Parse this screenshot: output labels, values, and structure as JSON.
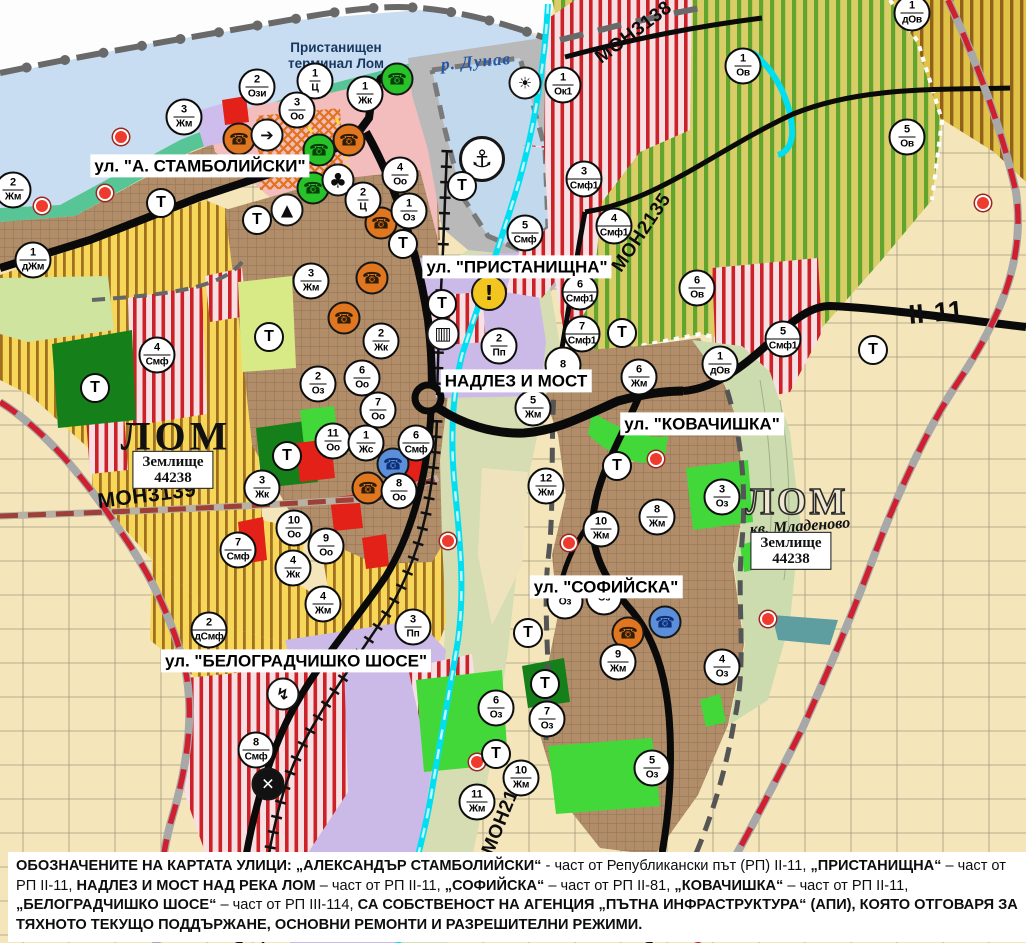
{
  "map": {
    "street_labels": [
      {
        "text": "ул. \"А. СТАМБОЛИЙСКИ\"",
        "x": 200,
        "y": 166
      },
      {
        "text": "ул. \"ПРИСТАНИЩНА\"",
        "x": 517,
        "y": 267
      },
      {
        "text": "НАДЛЕЗ И МОСТ",
        "x": 516,
        "y": 381
      },
      {
        "text": "ул. \"КОВАЧИШКА\"",
        "x": 702,
        "y": 424
      },
      {
        "text": "ул. \"СОФИЙСКА\"",
        "x": 606,
        "y": 587
      },
      {
        "text": "ул. \"БЕЛОГРАДЧИШКО ШОСЕ\"",
        "x": 296,
        "y": 661
      }
    ],
    "area_labels": [
      {
        "text": "р. Дунав",
        "x": 476,
        "y": 62,
        "rot": -5,
        "style": "river"
      },
      {
        "text": "Пристанищен\nтерминал Лом",
        "x": 336,
        "y": 56,
        "rot": 0,
        "style": "terminal"
      },
      {
        "text": "ЛОМ",
        "x": 176,
        "y": 436,
        "rot": 0,
        "style": "lom"
      },
      {
        "text": "ЛОМ",
        "x": 797,
        "y": 502,
        "rot": 0,
        "style": "lom-outline"
      },
      {
        "text": "кв. Младеново",
        "x": 800,
        "y": 527,
        "rot": -4,
        "style": "kvartal"
      }
    ],
    "road_labels": [
      {
        "text": "МОН3139",
        "x": 147,
        "y": 496,
        "rot": -7,
        "size": 21
      },
      {
        "text": "МОН3138",
        "x": 634,
        "y": 33,
        "rot": -37,
        "size": 19
      },
      {
        "text": "МОН2135",
        "x": 642,
        "y": 233,
        "rot": -56,
        "size": 19
      },
      {
        "text": "МОН2136",
        "x": 505,
        "y": 812,
        "rot": -68,
        "size": 19
      },
      {
        "text": "II-11",
        "x": 936,
        "y": 313,
        "rot": -5,
        "size": 27
      }
    ],
    "landholding_boxes": [
      {
        "lines": [
          "Землище",
          "44238"
        ],
        "x": 173,
        "y": 470
      },
      {
        "lines": [
          "Землище",
          "44238"
        ],
        "x": 791,
        "y": 551
      }
    ],
    "zone_markers": [
      {
        "n": "2",
        "c": "Ози",
        "x": 257,
        "y": 87
      },
      {
        "n": "1",
        "c": "Ц",
        "x": 315,
        "y": 81
      },
      {
        "n": "1",
        "c": "Жк",
        "x": 365,
        "y": 94
      },
      {
        "n": "3",
        "c": "Оо",
        "x": 297,
        "y": 110
      },
      {
        "n": "3",
        "c": "Жм",
        "x": 184,
        "y": 117
      },
      {
        "n": "2",
        "c": "Жм",
        "x": 13,
        "y": 190
      },
      {
        "n": "1",
        "c": "дЖм",
        "x": 33,
        "y": 260
      },
      {
        "n": "4",
        "c": "Оо",
        "x": 400,
        "y": 175
      },
      {
        "n": "2",
        "c": "Ц",
        "x": 363,
        "y": 200
      },
      {
        "n": "1",
        "c": "Оз",
        "x": 409,
        "y": 211
      },
      {
        "n": "1",
        "c": "Ок1",
        "x": 563,
        "y": 85
      },
      {
        "n": "5",
        "c": "Смф",
        "x": 525,
        "y": 233
      },
      {
        "n": "3",
        "c": "Смф1",
        "x": 584,
        "y": 179
      },
      {
        "n": "4",
        "c": "Смф1",
        "x": 614,
        "y": 226
      },
      {
        "n": "6",
        "c": "Смф1",
        "x": 580,
        "y": 292
      },
      {
        "n": "7",
        "c": "Смф1",
        "x": 582,
        "y": 334
      },
      {
        "n": "2",
        "c": "Жк",
        "x": 381,
        "y": 341
      },
      {
        "n": "6",
        "c": "Оо",
        "x": 362,
        "y": 378
      },
      {
        "n": "2",
        "c": "Пп",
        "x": 499,
        "y": 346
      },
      {
        "n": "8",
        "c": "",
        "x": 563,
        "y": 365,
        "b": true
      },
      {
        "n": "3",
        "c": "Жм",
        "x": 311,
        "y": 281
      },
      {
        "n": "2",
        "c": "Оз",
        "x": 318,
        "y": 384
      },
      {
        "n": "7",
        "c": "Оо",
        "x": 378,
        "y": 410
      },
      {
        "n": "11",
        "c": "Оо",
        "x": 333,
        "y": 441
      },
      {
        "n": "1",
        "c": "Жс",
        "x": 366,
        "y": 443
      },
      {
        "n": "6",
        "c": "Смф",
        "x": 416,
        "y": 443
      },
      {
        "n": "3",
        "c": "Жк",
        "x": 262,
        "y": 488
      },
      {
        "n": "8",
        "c": "Оо",
        "x": 399,
        "y": 491
      },
      {
        "n": "10",
        "c": "Оо",
        "x": 294,
        "y": 528
      },
      {
        "n": "9",
        "c": "Оо",
        "x": 326,
        "y": 546
      },
      {
        "n": "4",
        "c": "Жк",
        "x": 293,
        "y": 568
      },
      {
        "n": "7",
        "c": "Смф",
        "x": 238,
        "y": 550
      },
      {
        "n": "4",
        "c": "Жм",
        "x": 323,
        "y": 604
      },
      {
        "n": "4",
        "c": "Смф",
        "x": 157,
        "y": 355
      },
      {
        "n": "6",
        "c": "Жм",
        "x": 639,
        "y": 377
      },
      {
        "n": "5",
        "c": "Жм",
        "x": 533,
        "y": 408
      },
      {
        "n": "12",
        "c": "Жм",
        "x": 546,
        "y": 486
      },
      {
        "n": "3",
        "c": "Оз",
        "x": 722,
        "y": 497
      },
      {
        "n": "8",
        "c": "Жм",
        "x": 657,
        "y": 517
      },
      {
        "n": "10",
        "c": "Жм",
        "x": 601,
        "y": 529
      },
      {
        "n": "",
        "c": "Оз",
        "x": 565,
        "y": 601,
        "b": true
      },
      {
        "n": "",
        "c": "Оз",
        "x": 604,
        "y": 597,
        "b": true
      },
      {
        "n": "9",
        "c": "Жм",
        "x": 618,
        "y": 662
      },
      {
        "n": "4",
        "c": "Оз",
        "x": 722,
        "y": 667
      },
      {
        "n": "6",
        "c": "Оз",
        "x": 496,
        "y": 708
      },
      {
        "n": "7",
        "c": "Оз",
        "x": 547,
        "y": 719
      },
      {
        "n": "10",
        "c": "Жм",
        "x": 521,
        "y": 778
      },
      {
        "n": "11",
        "c": "Жм",
        "x": 477,
        "y": 802
      },
      {
        "n": "5",
        "c": "Оз",
        "x": 652,
        "y": 768
      },
      {
        "n": "2",
        "c": "дСмф",
        "x": 209,
        "y": 630
      },
      {
        "n": "3",
        "c": "Пп",
        "x": 413,
        "y": 627
      },
      {
        "n": "8",
        "c": "Смф",
        "x": 256,
        "y": 750
      },
      {
        "n": "1",
        "c": "Ов",
        "x": 743,
        "y": 66
      },
      {
        "n": "5",
        "c": "Ов",
        "x": 907,
        "y": 137
      },
      {
        "n": "1",
        "c": "дОв",
        "x": 912,
        "y": 13
      },
      {
        "n": "6",
        "c": "Ов",
        "x": 697,
        "y": 288
      },
      {
        "n": "1",
        "c": "дОв",
        "x": 720,
        "y": 364
      },
      {
        "n": "5",
        "c": "Смф1",
        "x": 783,
        "y": 339
      }
    ],
    "t_markers": [
      {
        "x": 161,
        "y": 203
      },
      {
        "x": 257,
        "y": 220
      },
      {
        "x": 403,
        "y": 244
      },
      {
        "x": 462,
        "y": 186
      },
      {
        "x": 442,
        "y": 304
      },
      {
        "x": 622,
        "y": 333
      },
      {
        "x": 873,
        "y": 350
      },
      {
        "x": 269,
        "y": 337
      },
      {
        "x": 287,
        "y": 456
      },
      {
        "x": 95,
        "y": 388
      },
      {
        "x": 617,
        "y": 466
      },
      {
        "x": 528,
        "y": 633
      },
      {
        "x": 545,
        "y": 684
      },
      {
        "x": 496,
        "y": 754
      }
    ],
    "t_label": "Т",
    "poi_icons": [
      {
        "type": "monument-icon",
        "cls": "orange",
        "g": "☎",
        "x": 239,
        "y": 139
      },
      {
        "type": "monument-icon",
        "cls": "orange",
        "g": "☎",
        "x": 349,
        "y": 140
      },
      {
        "type": "monument-icon",
        "cls": "orange",
        "g": "☎",
        "x": 381,
        "y": 223
      },
      {
        "type": "monument-icon",
        "cls": "orange",
        "g": "☎",
        "x": 372,
        "y": 278
      },
      {
        "type": "monument-icon",
        "cls": "orange",
        "g": "☎",
        "x": 344,
        "y": 318
      },
      {
        "type": "monument-icon",
        "cls": "orange",
        "g": "☎",
        "x": 368,
        "y": 488
      },
      {
        "type": "monument-icon",
        "cls": "orange",
        "g": "☎",
        "x": 628,
        "y": 633
      },
      {
        "type": "monument-icon",
        "cls": "green",
        "g": "☎",
        "x": 397,
        "y": 79
      },
      {
        "type": "monument-icon",
        "cls": "green",
        "g": "☎",
        "x": 319,
        "y": 150
      },
      {
        "type": "monument-icon",
        "cls": "green",
        "g": "☎",
        "x": 313,
        "y": 188
      },
      {
        "type": "monument-icon",
        "cls": "blue",
        "g": "☎",
        "x": 393,
        "y": 464
      },
      {
        "type": "monument-icon",
        "cls": "blue",
        "g": "☎",
        "x": 665,
        "y": 622
      },
      {
        "type": "arrow-icon",
        "cls": "white",
        "g": "➔",
        "x": 267,
        "y": 135
      },
      {
        "type": "clover-icon",
        "cls": "white clover",
        "g": "♣",
        "x": 338,
        "y": 180
      },
      {
        "type": "mountain-icon",
        "cls": "white",
        "g": "▲",
        "x": 287,
        "y": 210
      },
      {
        "type": "anchor-icon",
        "cls": "white anchor",
        "g": "⚓",
        "x": 482,
        "y": 159
      },
      {
        "type": "sun-icon",
        "cls": "white",
        "g": "☀",
        "x": 525,
        "y": 83
      },
      {
        "type": "warning-icon",
        "cls": "warning",
        "g": "!",
        "x": 489,
        "y": 293
      },
      {
        "type": "bus-icon",
        "cls": "white bus",
        "g": "▥",
        "x": 443,
        "y": 334
      },
      {
        "type": "lightning-icon",
        "cls": "white",
        "g": "↯",
        "x": 283,
        "y": 694
      },
      {
        "type": "rail-crossing-icon",
        "cls": "dark",
        "g": "✕",
        "x": 268,
        "y": 784
      }
    ],
    "red_dots": [
      {
        "x": 121,
        "y": 137
      },
      {
        "x": 105,
        "y": 193
      },
      {
        "x": 42,
        "y": 206
      },
      {
        "x": 656,
        "y": 459
      },
      {
        "x": 569,
        "y": 543
      },
      {
        "x": 448,
        "y": 541
      },
      {
        "x": 477,
        "y": 762
      },
      {
        "x": 983,
        "y": 203
      },
      {
        "x": 768,
        "y": 619
      }
    ]
  },
  "legend_note": {
    "segments": [
      {
        "t": "ОБОЗНАЧЕНИТЕ НА КАРТАТА УЛИЦИ: „АЛЕКСАНДЪР СТАМБОЛИЙСКИ“",
        "b": true
      },
      {
        "t": " - част от Републикански път (РП) II-11, ",
        "b": false
      },
      {
        "t": "„ПРИСТАНИЩНА“",
        "b": true
      },
      {
        "t": " – част от РП II-11, ",
        "b": false
      },
      {
        "t": "НАДЛЕЗ И МОСТ НАД РЕКА ЛОМ",
        "b": true
      },
      {
        "t": " – част от РП II-11, ",
        "b": false
      },
      {
        "t": "„СОФИЙСКА“",
        "b": true
      },
      {
        "t": " – част от РП II-81, ",
        "b": false
      },
      {
        "t": "„КОВАЧИШКА“",
        "b": true
      },
      {
        "t": " – част от РП II-11, ",
        "b": false
      },
      {
        "t": "„БЕЛОГРАДЧИШКО ШОСЕ“",
        "b": true
      },
      {
        "t": " – част от РП III-114, ",
        "b": false
      },
      {
        "t": "СА СОБСТВЕНОСТ НА АГЕНЦИЯ „ПЪТНА ИНФРАСТРУКТУРА“ (АПИ), КОЯТО ОТГОВАРЯ ЗА ТЯХНОТО ТЕКУЩО ПОДДЪРЖАНЕ, ОСНОВНИ РЕМОНТИ И РАЗРЕШИТЕЛНИ РЕЖИМИ.",
        "b": true
      }
    ]
  }
}
